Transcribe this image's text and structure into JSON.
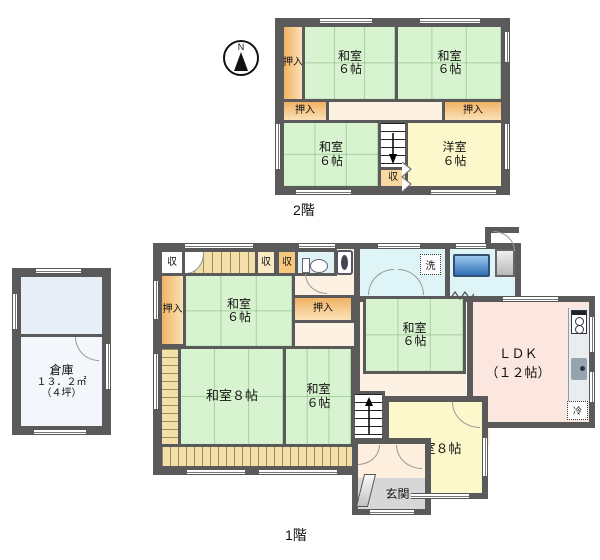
{
  "compass": {
    "north": "N"
  },
  "floor2": {
    "label": "2階",
    "oshiire_top": "押入",
    "oshiire_left": "押入",
    "oshiire_right": "押入",
    "washitsu_tl": {
      "name": "和室",
      "size": "６帖"
    },
    "washitsu_tr": {
      "name": "和室",
      "size": "６帖"
    },
    "washitsu_bl": {
      "name": "和室",
      "size": "６帖"
    },
    "stair_closet": "収",
    "yoshitsu": {
      "name": "洋室",
      "size": "６帖"
    }
  },
  "floor1": {
    "label": "1階",
    "closet_a": "収",
    "closet_b": "収",
    "closet_c": "収",
    "oshiire_left": "押入",
    "oshiire_mid": "押入",
    "washitsu_ul": {
      "name": "和室",
      "size": "６帖"
    },
    "washitsu_mid": {
      "name": "和室",
      "size": "６帖"
    },
    "washitsu_bottom": {
      "name": "和室",
      "size": "６帖"
    },
    "washitsu_8": "和室８帖",
    "yoshitsu_8": "洋室８帖",
    "ldk": {
      "name": "ＬＤＫ",
      "size": "（１２帖）"
    },
    "laundry": "洗",
    "fridge": "冷",
    "genkan": "玄関"
  },
  "annex": {
    "name": "倉庫",
    "area_sqm": "１３．２㎡",
    "area_tsubo": "（４坪）"
  },
  "colors": {
    "wall": "#5a5a5a",
    "tatami": "#d8f3cf",
    "western": "#fdf8cc",
    "closet": "#f0b264",
    "hall": "#fdf1e3",
    "ldk": "#fbe7df",
    "wet": "#def4f6",
    "bathtub": "#3a79c0",
    "genkan_floor": "#d7d7d7",
    "veranda": "#f3dfa8"
  }
}
